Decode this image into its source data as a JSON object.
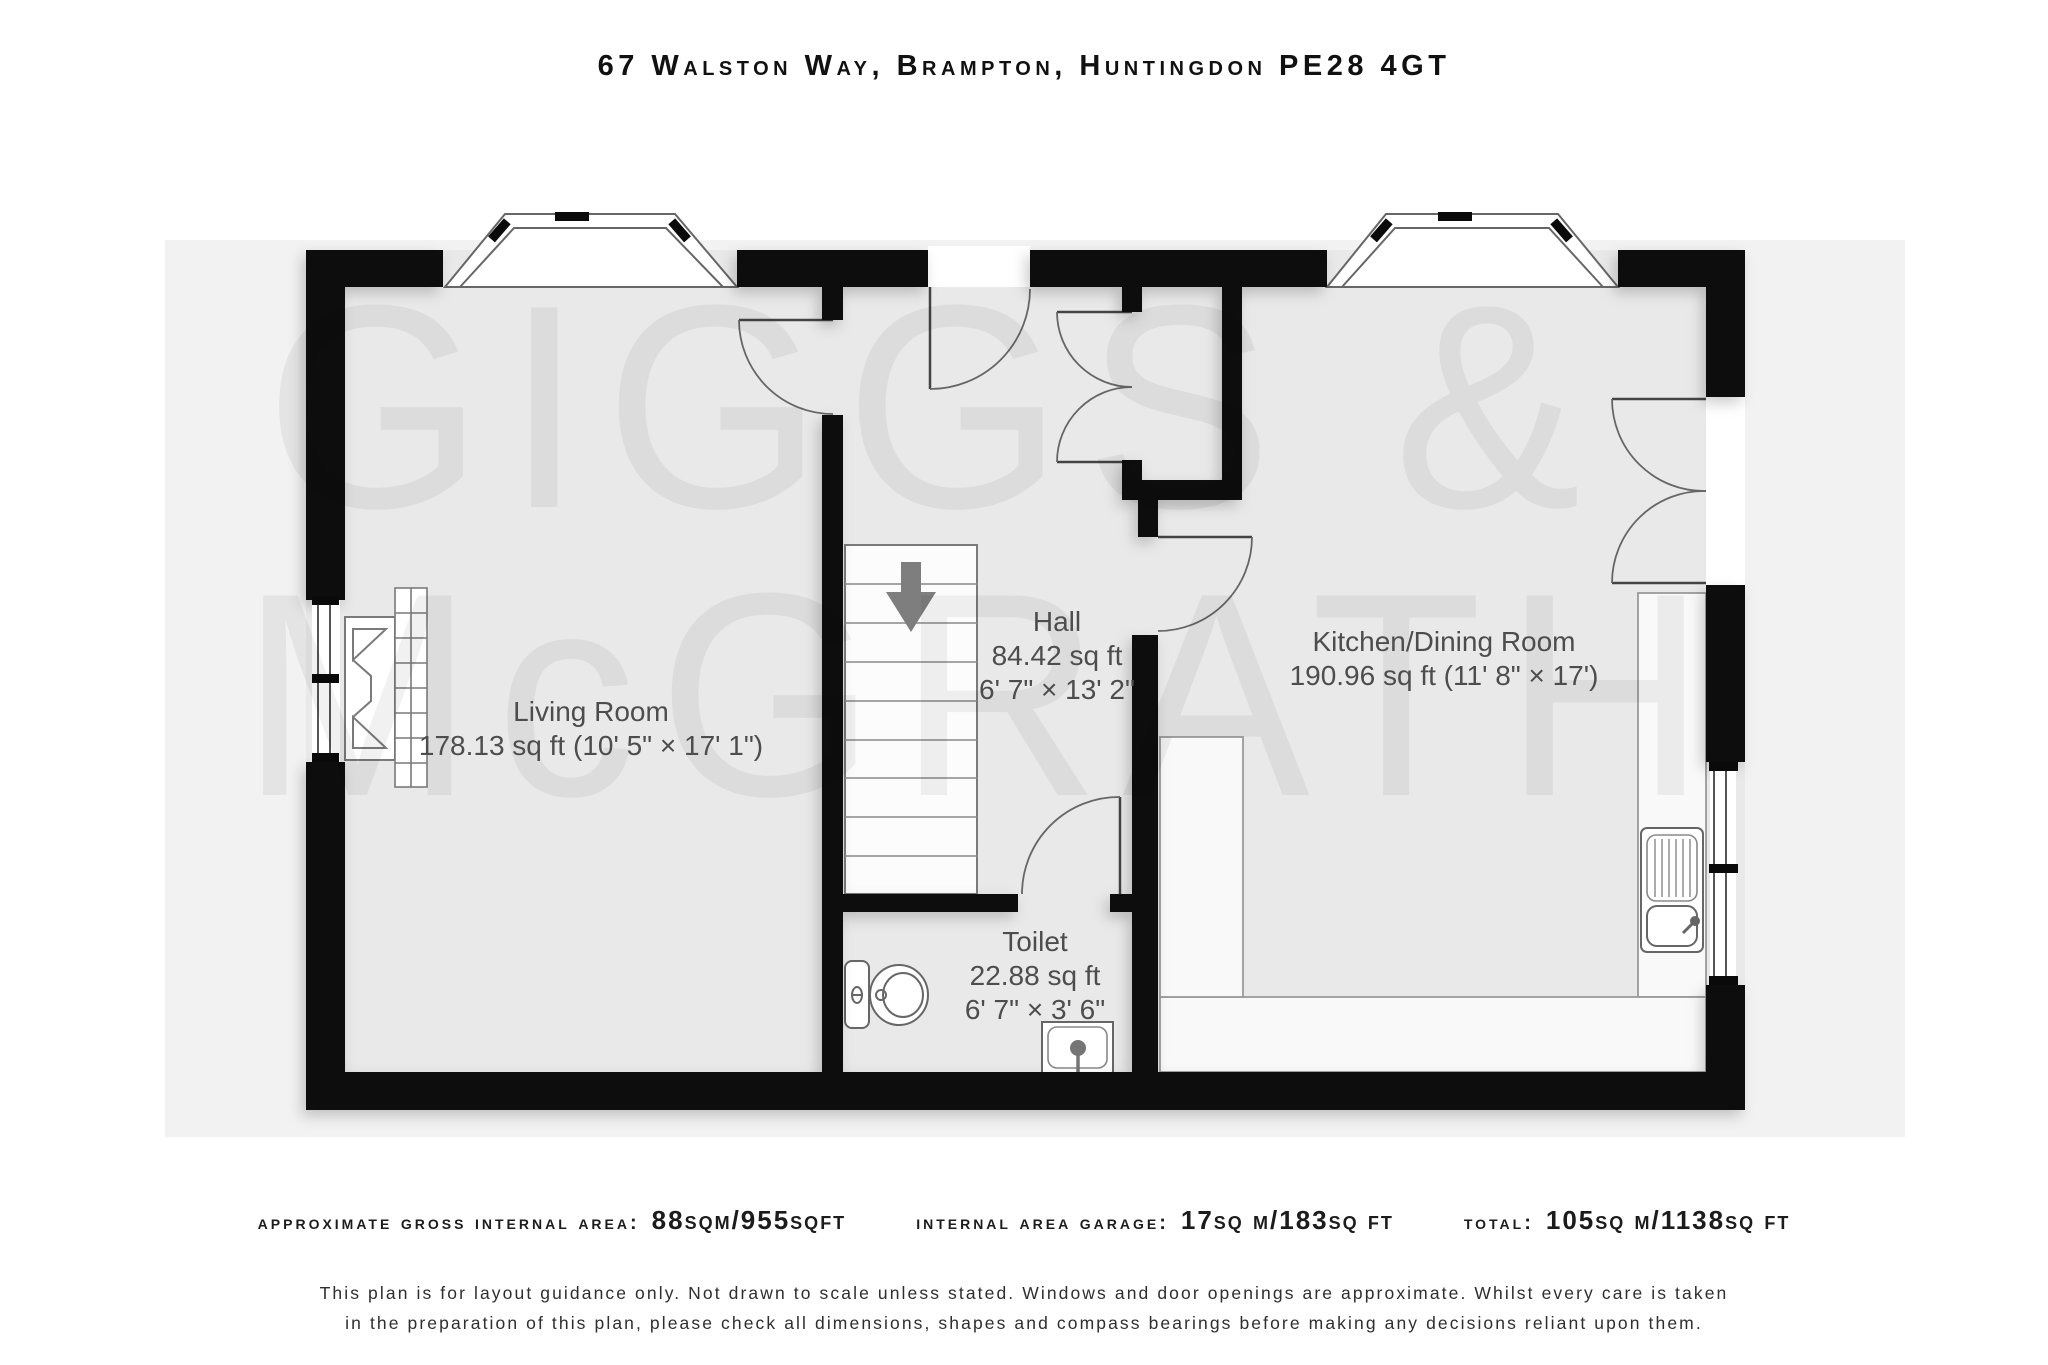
{
  "title": "67 Walston Way, Brampton, Huntingdon PE28 4GT",
  "watermark": {
    "line1": "GIGGS &",
    "line2": "McGRATH"
  },
  "rooms": {
    "living": {
      "name": "Living Room",
      "area": "178.13 sq ft (10' 5\" × 17' 1\")"
    },
    "hall": {
      "name": "Hall",
      "area": "84.42 sq ft",
      "dims": "6' 7\" × 13' 2\""
    },
    "kitchen": {
      "name": "Kitchen/Dining Room",
      "area": "190.96 sq ft (11' 8\" × 17')"
    },
    "toilet": {
      "name": "Toilet",
      "area": "22.88 sq ft",
      "dims": "6' 7\" × 3' 6\""
    }
  },
  "footer": {
    "stats": [
      {
        "label": "approximate gross internal area:",
        "value": "88sqm/955sqft"
      },
      {
        "label": "internal area garage:",
        "value": "17sq m/183sq ft"
      },
      {
        "label": "total:",
        "value": "105sq m/1138sq ft"
      }
    ],
    "disclaimer_line1": "This plan is for layout guidance only. Not drawn to scale unless stated. Windows and door openings are approximate. Whilst every care is taken",
    "disclaimer_line2": "in the preparation of this plan, please check all dimensions, shapes and compass bearings before making any decisions reliant upon them."
  },
  "colors": {
    "wall": "#0a0a0a",
    "floor": "#e9e9e9",
    "band": "#f2f2f2",
    "accent_arrow": "#7e7e7e"
  }
}
